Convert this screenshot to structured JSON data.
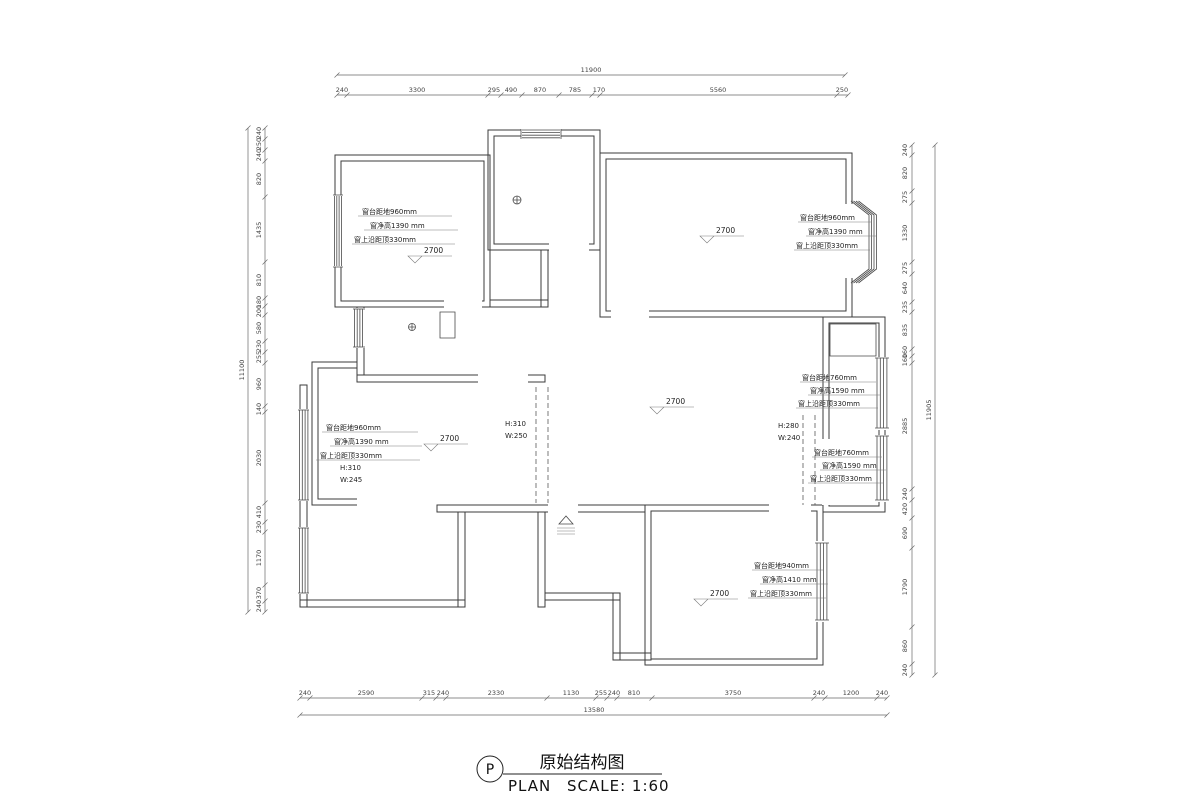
{
  "drawing": {
    "title_cn": "原始结构图",
    "plan_label": "PLAN",
    "scale_label": "SCALE: 1:60",
    "symbol_letter": "P"
  },
  "ceiling_height_markers": [
    "2700",
    "2700",
    "2700",
    "2700",
    "2700"
  ],
  "window_annotations": {
    "top_left": [
      "窗台距地960mm",
      "窗净高1390 mm",
      "窗上沿距顶330mm"
    ],
    "top_right": [
      "窗台距地960mm",
      "窗净高1390 mm",
      "窗上沿距顶330mm"
    ],
    "right_upper": [
      "窗台距地760mm",
      "窗净高1590 mm",
      "窗上沿距顶330mm"
    ],
    "right_lower": [
      "窗台距地760mm",
      "窗净高1590 mm",
      "窗上沿距顶330mm"
    ],
    "left_living": [
      "窗台距地960mm",
      "窗净高1390 mm",
      "窗上沿距顶330mm"
    ],
    "bottom_right": [
      "窗台距地940mm",
      "窗净高1410 mm",
      "窗上沿距顶330mm"
    ]
  },
  "beam_labels": {
    "left_bay": [
      "H:310",
      "W:245"
    ],
    "center": [
      "H:310",
      "W:250"
    ],
    "right": [
      "H:280",
      "W:240"
    ]
  },
  "dimensions": {
    "top": {
      "total": "11900",
      "segments": [
        "240",
        "3300",
        "295",
        "490",
        "870",
        "785",
        "170",
        "5560",
        "250"
      ]
    },
    "bottom": {
      "total": "13580",
      "segments": [
        "240",
        "2590",
        "315",
        "240",
        "2330",
        "1130",
        "255",
        "240",
        "810",
        "3750",
        "240",
        "1200",
        "240"
      ]
    },
    "left": {
      "total": "11100",
      "segments": [
        "240",
        "250",
        "240",
        "820",
        "1435",
        "810",
        "180",
        "200",
        "580",
        "230",
        "255",
        "960",
        "140",
        "2030",
        "410",
        "230",
        "1170",
        "370",
        "240"
      ]
    },
    "right": {
      "total": "11905",
      "segments": [
        "240",
        "820",
        "275",
        "1330",
        "275",
        "640",
        "235",
        "835",
        "160",
        "160",
        "2885",
        "240",
        "420",
        "690",
        "1790",
        "860",
        "240"
      ]
    }
  },
  "colors": {
    "line": "#3b3b3b",
    "dim_text": "#444444",
    "background": "#ffffff"
  }
}
